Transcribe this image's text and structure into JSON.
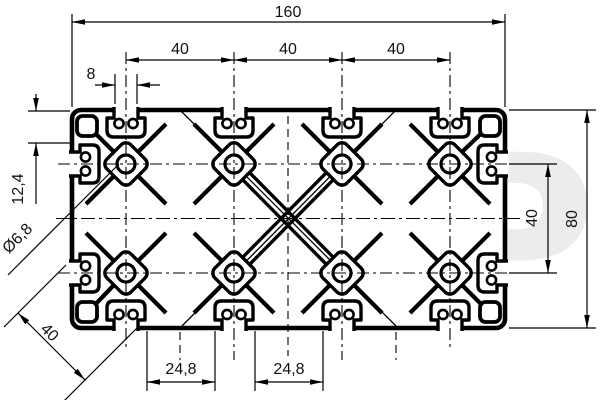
{
  "drawing": {
    "watermark": "CAP",
    "dims": {
      "overall_width": "160",
      "pitch": "40",
      "slot_opening": "8",
      "edge_offset": "12,4",
      "bore": "Ø6,8",
      "diagonal": "40",
      "bottom_opening": "24,8",
      "side_pitch": "40",
      "overall_height": "80"
    }
  }
}
